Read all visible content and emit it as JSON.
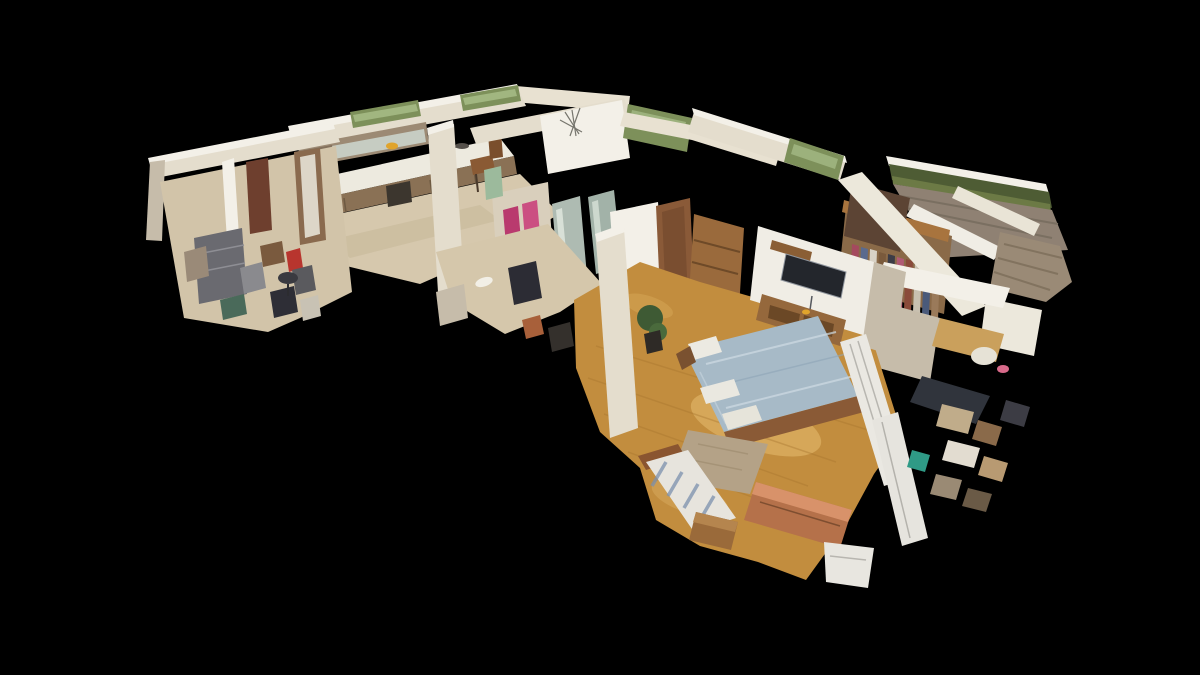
{
  "window": {
    "width": 1200,
    "height": 675,
    "background": "#000000"
  },
  "scene": {
    "type": "3d-dollhouse-cutaway-model",
    "subject": "apartment interior photogrammetry scan, tilted top-down view on black void",
    "rooms": [
      "entry-study",
      "kitchen",
      "hallway",
      "bathroom",
      "bedroom",
      "walk-in-closet",
      "balcony",
      "office-corner"
    ]
  },
  "palette": {
    "background": "#000000",
    "wall": "#e4ddcd",
    "wall_bright": "#f3f0e8",
    "wall_shadow": "#c6bcaa",
    "ceiling": "#e8e1d1",
    "floor_wood": "#c28d3e",
    "floor_wood_light": "#eac173",
    "floor_pale": "#d6c8ad",
    "hall_floor": "#d5c7ab",
    "study_floor": "#d2c4a9",
    "glass_green": "#7d905a",
    "glass_streak": "#aabf8a",
    "greenery": "#4e5c34",
    "hedge": "#6c7a45",
    "deck": "#8f8173",
    "counter": "#edeadf",
    "cabinet_wood": "#8a7155",
    "cabinet_upper": "#9c8a74",
    "cabinet_tall": "#83705c",
    "appliance_dark": "#3c362e",
    "bed_duvet": "#a7bac7",
    "bed_wood": "#8a5a36",
    "pillow": "#eceae2",
    "rug": "#b4a287",
    "towel_pink": "#b93a6e",
    "towel_pink_light": "#cb4f82",
    "towel_green": "#9cba9c",
    "towel_wall": "#d9cfbc",
    "glass_panel": "#aebbb2",
    "tv": "#23262c",
    "radiator": "#eae8e2",
    "copper": "#b5714a",
    "copper_light": "#d8926a",
    "maroon_door": "#6e3f2e",
    "door_wood": "#8a6a4e",
    "door_panel": "#ddd6c8",
    "bath_door": "#8a5a38",
    "shelf_cabinet": "#9a6a3c",
    "sideboard": "#95683c",
    "drawer_dark": "#6b4826",
    "nightstand": "#9a6a3a",
    "nightstand_top": "#b5854e",
    "daybed": "#e7e4dd",
    "daybed_stripe": "#7c90ad",
    "plant": "#3e5a34",
    "plant_light": "#4a6a3c",
    "pot": "#2e2a26",
    "wardrobe_wood": "#8a6a48",
    "shelf_wood": "#a8743e",
    "dark_brown": "#5c4434",
    "desk_dark": "#30343c",
    "teal": "#2f9a86",
    "orange": "#e0a42c",
    "pink_item": "#d86a8a",
    "cat_white": "#f2efe6",
    "bag_dark": "#2c2c34",
    "clothes": [
      "#a44a5e",
      "#5a6a8e",
      "#d8d2c6",
      "#7a5a3c",
      "#3c3c46",
      "#b05a74",
      "#8a4a3a",
      "#c8c0b0",
      "#4a5a7a",
      "#9a7a5a"
    ],
    "clutter": [
      "#7a5a3e",
      "#8a8a8e",
      "#b8352e",
      "#5a5a5e",
      "#2e2e36",
      "#c8c2b4",
      "#4a6a5a",
      "#9a8a78"
    ],
    "office_clutter": [
      "#c0ac8a",
      "#8a6a4a",
      "#3c3c44",
      "#e2dcd0",
      "#b89a72",
      "#2f9a86",
      "#9a8a74",
      "#6a5a46"
    ]
  }
}
